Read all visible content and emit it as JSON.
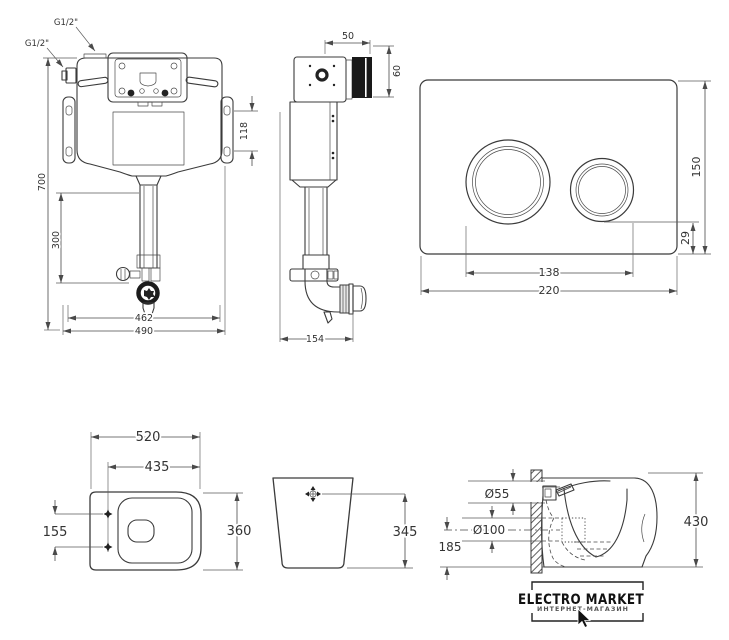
{
  "views": {
    "cistern_front": {
      "inlet_top_label": "G1/2\"",
      "inlet_side_label": "G1/2\"",
      "overall_height": "700",
      "flush_pipe_height": "300",
      "bracket_hole_spacing": "118",
      "inner_width": "462",
      "overall_width": "490"
    },
    "cistern_side": {
      "top_depth": "50",
      "frame_height": "60",
      "overall_depth": "154"
    },
    "flush_plate": {
      "height": "150",
      "button_bottom_offset": "29",
      "buttons_span": "138",
      "width": "220"
    },
    "pan_top": {
      "overall_length": "520",
      "bowl_length": "435",
      "fixing_hole_spacing": "155",
      "overall_width": "360"
    },
    "pan_back": {
      "inlet_height": "345"
    },
    "pan_side": {
      "inlet_diameter": "Ø55",
      "outlet_diameter": "Ø100",
      "outlet_height": "185",
      "overall_height": "430"
    }
  },
  "logo": {
    "title": "ELECTRO MARKET",
    "subtitle": "ИНТЕРНЕТ-МАГАЗИН"
  }
}
